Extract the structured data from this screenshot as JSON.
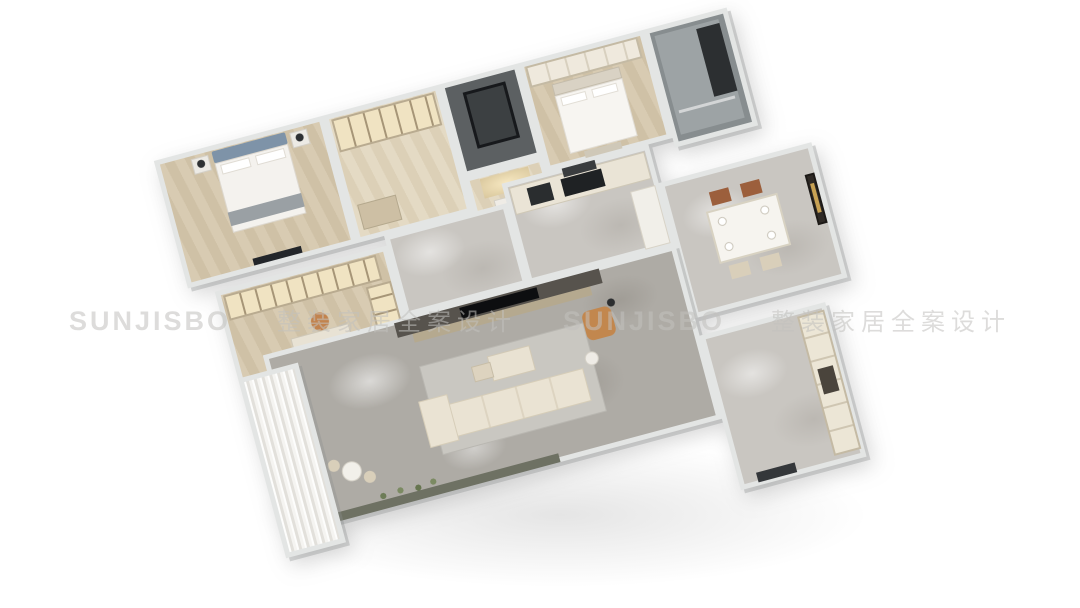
{
  "watermark": {
    "logo": "SUNJISBO",
    "tagline": "整装家居全案设计"
  },
  "palette": {
    "background": "#ffffff",
    "wall": "#e3e5e4",
    "wood_floor": "#d6c9b0",
    "marble_gray": "#aeaba5",
    "marble_light": "#c9c6c1",
    "bath_gray": "#878d8f",
    "shaft_dark": "#5c6062",
    "tv_wall_dark": "#57534d",
    "sofa_cream": "#eae3d3",
    "accent_tan": "#c2874e",
    "headboard_blue": "#7e93a8",
    "appliance_black": "#1f2224",
    "watermark_gray": "#c2c1be"
  },
  "rooms": [
    "master-bedroom",
    "walk-in-closet",
    "shower-shaft",
    "foyer",
    "bedroom-2",
    "bathroom",
    "study",
    "hallway",
    "kitchen",
    "dining-room",
    "living-room",
    "balcony",
    "pantry-wing"
  ]
}
